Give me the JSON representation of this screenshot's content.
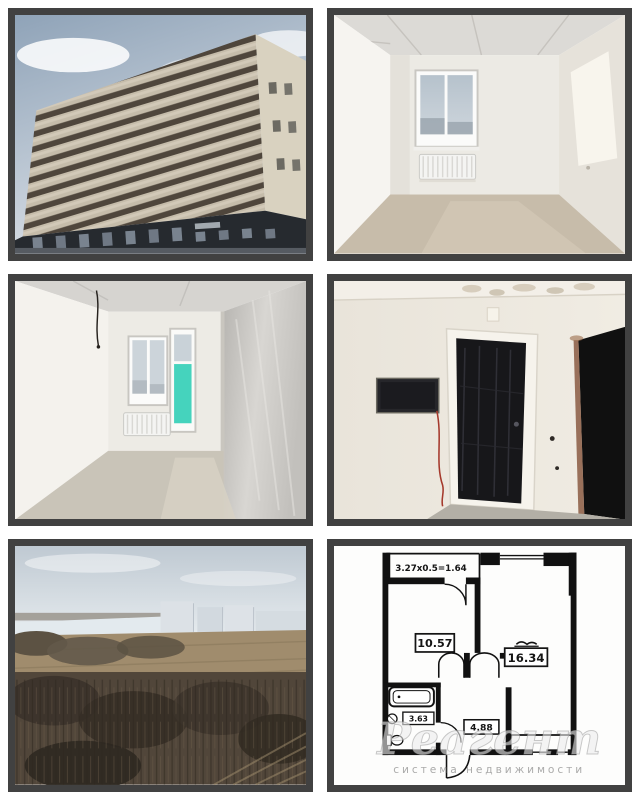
{
  "page": {
    "title": "Фотографии квартиры",
    "colors": {
      "background": "#ffffff",
      "tile_border": "#414141",
      "plan_wall": "#111111",
      "balcony_film_teal": "#45d3bd",
      "watermark_gray": "#b5b5b5"
    }
  },
  "gallery": {
    "photos": [
      {
        "id": "building-exterior",
        "description": "Высотный многоэтажный жилой дом, бежевый фасад с тёмными балконами, облачное небо"
      },
      {
        "id": "empty-room-window",
        "description": "Пустая комната без отделки, окно с видом на город, белый радиатор, бетонный пол"
      },
      {
        "id": "empty-room-balcony",
        "description": "Пустая комната, окно и балконная дверь с бирюзовой плёнкой, радиатор, серая штукатурка"
      },
      {
        "id": "entrance-hallway",
        "description": "Прихожая, чёрная входная дверь в плёнке, электрощиток с красным проводом, тёмный проём"
      },
      {
        "id": "window-view-landscape",
        "description": "Вид из окна: деревья, поле, река и городские дома на горизонте"
      },
      {
        "id": "floor-plan",
        "description": "Планировка однокомнатной квартиры с размерами помещений"
      }
    ]
  },
  "floor_plan": {
    "balcony_dimension_label": "3.27x0.5=1.64",
    "room_areas": {
      "kitchen": "10.57",
      "living_room": "16.34",
      "bathroom": "3.63",
      "hallway": "4.88"
    },
    "watermark": {
      "brand": "Реагент",
      "tagline": "система недвижимости"
    }
  }
}
